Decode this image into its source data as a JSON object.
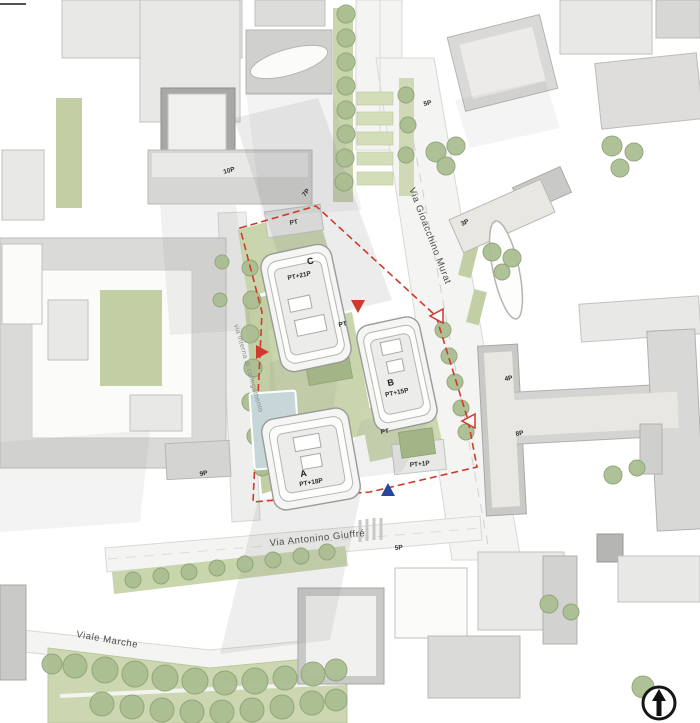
{
  "page": {
    "title": "Architectural masterplan site plan"
  },
  "streets": {
    "murat": "Via Gioacchino Murat",
    "giuffre": "Via Antonino Giuffré",
    "marche": "Viale Marche",
    "interna": "via interna di collegamento"
  },
  "towers": {
    "a": {
      "name": "A",
      "floors": "PT+18P"
    },
    "b": {
      "name": "B",
      "floors": "PT+15P"
    },
    "c": {
      "name": "C",
      "floors": "PT+21P"
    }
  },
  "labels": {
    "tl_10p": "10P",
    "tl_7p": "7P",
    "pt_top": "PT",
    "pt_mid": "PT",
    "pt_garden": "PT",
    "pt_plus_1p": "PT+1P",
    "left_9p": "9P",
    "tr_5p": "5P",
    "right_3p": "3P",
    "right_4p": "4P",
    "right_8p": "8P",
    "bottom_5p": "5P"
  },
  "markers": {
    "boundary_red": "#cf3a2c",
    "arrow_blue": "#27479e"
  },
  "colors": {
    "green_light": "#c9d5ad",
    "tree_green": "#abbe92",
    "building_gray": "#dcdcda",
    "pool_blue": "#c7d6d9"
  },
  "north_arrow": {
    "icon": "north-arrow-icon"
  }
}
